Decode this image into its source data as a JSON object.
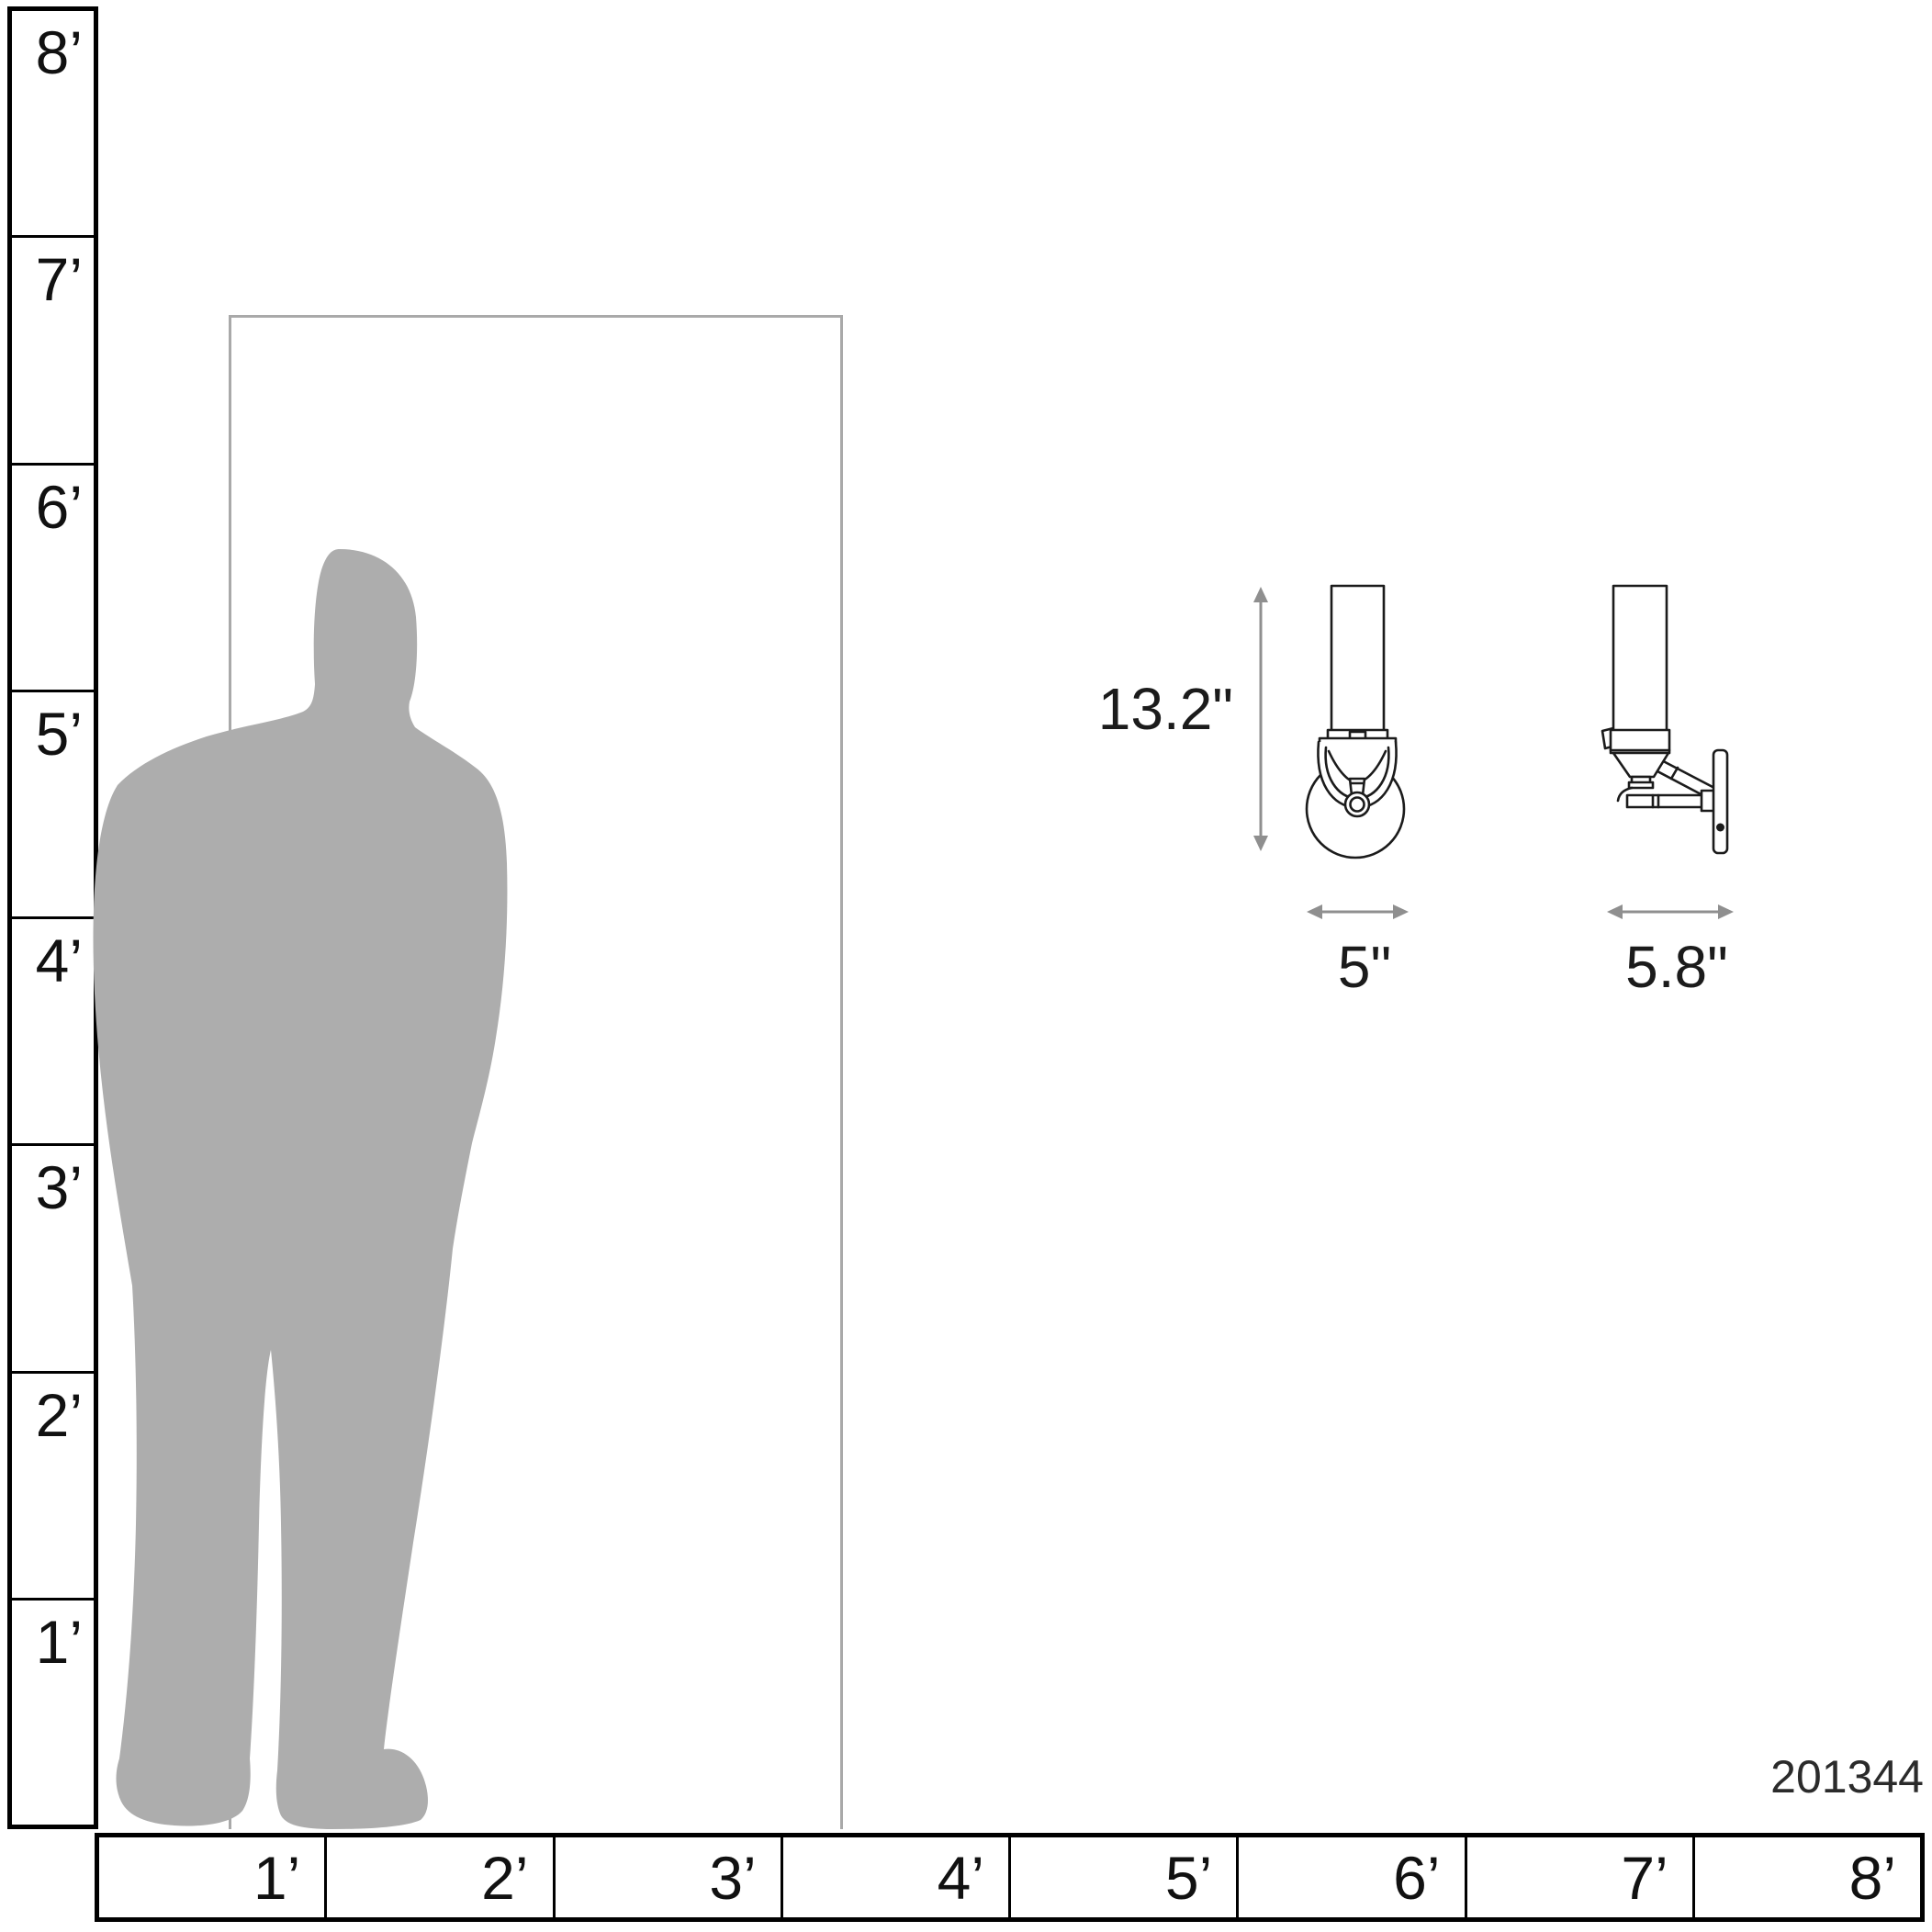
{
  "product_code": "201344",
  "dimension_labels": {
    "height": "13.2\"",
    "width": "5\"",
    "depth": "5.8\""
  },
  "vertical_ruler": {
    "labels": [
      "8’",
      "7’",
      "6’",
      "5’",
      "4’",
      "3’",
      "2’",
      "1’"
    ]
  },
  "horizontal_ruler": {
    "labels": [
      "1’",
      "2’",
      "3’",
      "4’",
      "5’",
      "6’",
      "7’",
      "8’"
    ]
  },
  "colors": {
    "ruler_line": "#000000",
    "drawing_line": "#1b1b1b",
    "dimension_arrow": "#8f8f8f",
    "silhouette": "#adadad",
    "door_outline": "#a9a9a9",
    "text": "#1b1b1b"
  }
}
